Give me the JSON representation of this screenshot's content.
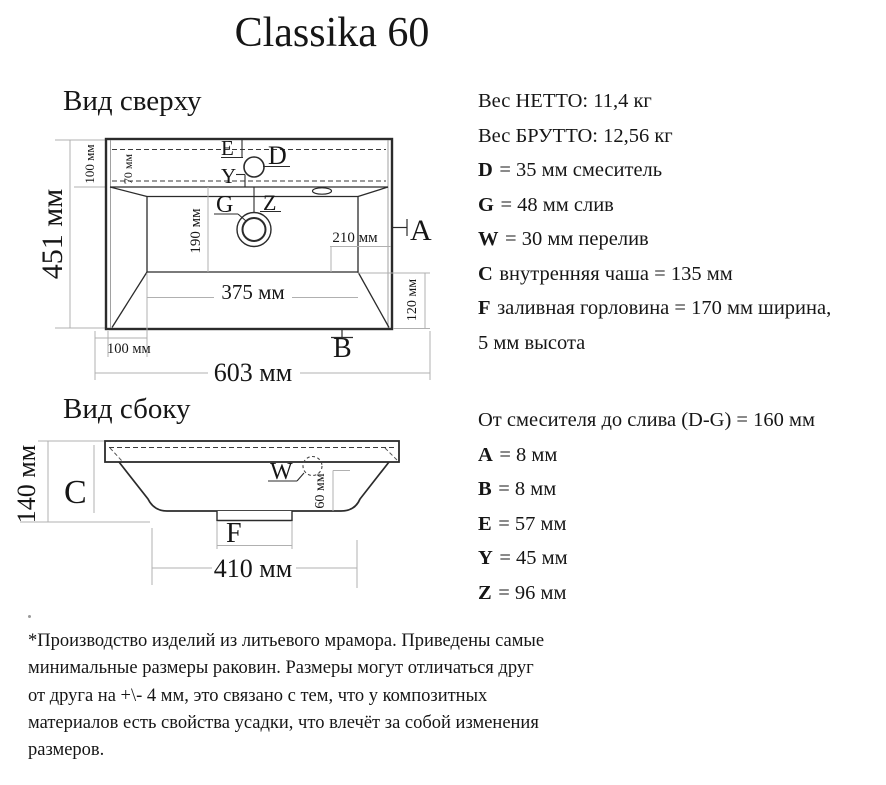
{
  "title": "Classika 60",
  "top_view": {
    "heading": "Вид сверху",
    "dims": {
      "total_height": "451 мм",
      "back_depth": "100 мм",
      "inner_back": "70 мм",
      "bowl_depth": "190 мм",
      "right_offset": "210 мм",
      "bowl_width": "375 мм",
      "front_right": "120 мм",
      "left_offset": "100 мм",
      "total_width": "603 мм"
    },
    "labels": {
      "e": "E",
      "d": "D",
      "y": "Y",
      "g": "G",
      "z": "Z",
      "a": "A",
      "b": "B"
    }
  },
  "side_view": {
    "heading": "Вид сбоку",
    "dims": {
      "total_height": "140 мм",
      "overflow_height": "60 мм",
      "bottom_width": "410 мм"
    },
    "labels": {
      "c": "C",
      "w": "W",
      "f": "F"
    }
  },
  "specs": {
    "weight_net": "Вес НЕТТО: 11,4 кг",
    "weight_gross": "Вес БРУТТО: 12,56 кг",
    "items": [
      {
        "key": "D",
        "rest": "= 35 мм смеситель"
      },
      {
        "key": "G",
        "rest": "= 48 мм слив"
      },
      {
        "key": "W",
        "rest": "= 30 мм перелив"
      },
      {
        "key": "C",
        "rest": "внутренняя чаша = 135 мм"
      },
      {
        "key": "F",
        "rest": "заливная горловина = 170 мм ширина,"
      }
    ],
    "f_line2": "5 мм высота",
    "distance": "От смесителя до слива (D-G) = 160 мм",
    "items2": [
      {
        "key": "A",
        "rest": "= 8 мм"
      },
      {
        "key": "B",
        "rest": "= 8 мм"
      },
      {
        "key": "E",
        "rest": "= 57 мм"
      },
      {
        "key": "Y",
        "rest": "= 45 мм"
      },
      {
        "key": "Z",
        "rest": "= 96 мм"
      }
    ]
  },
  "footer": {
    "lines": [
      "*Производство изделий из литьевого мрамора. Приведены самые",
      "минимальные размеры раковин. Размеры могут отличаться друг",
      "от друга на +\\- 4 мм, это связано с тем, что у композитных",
      "материалов есть свойства усадки, что влечёт за собой изменения",
      "размеров."
    ]
  },
  "colors": {
    "line_main": "#2b2b2b",
    "line_dim": "#b0b0b0",
    "text": "#161616"
  }
}
